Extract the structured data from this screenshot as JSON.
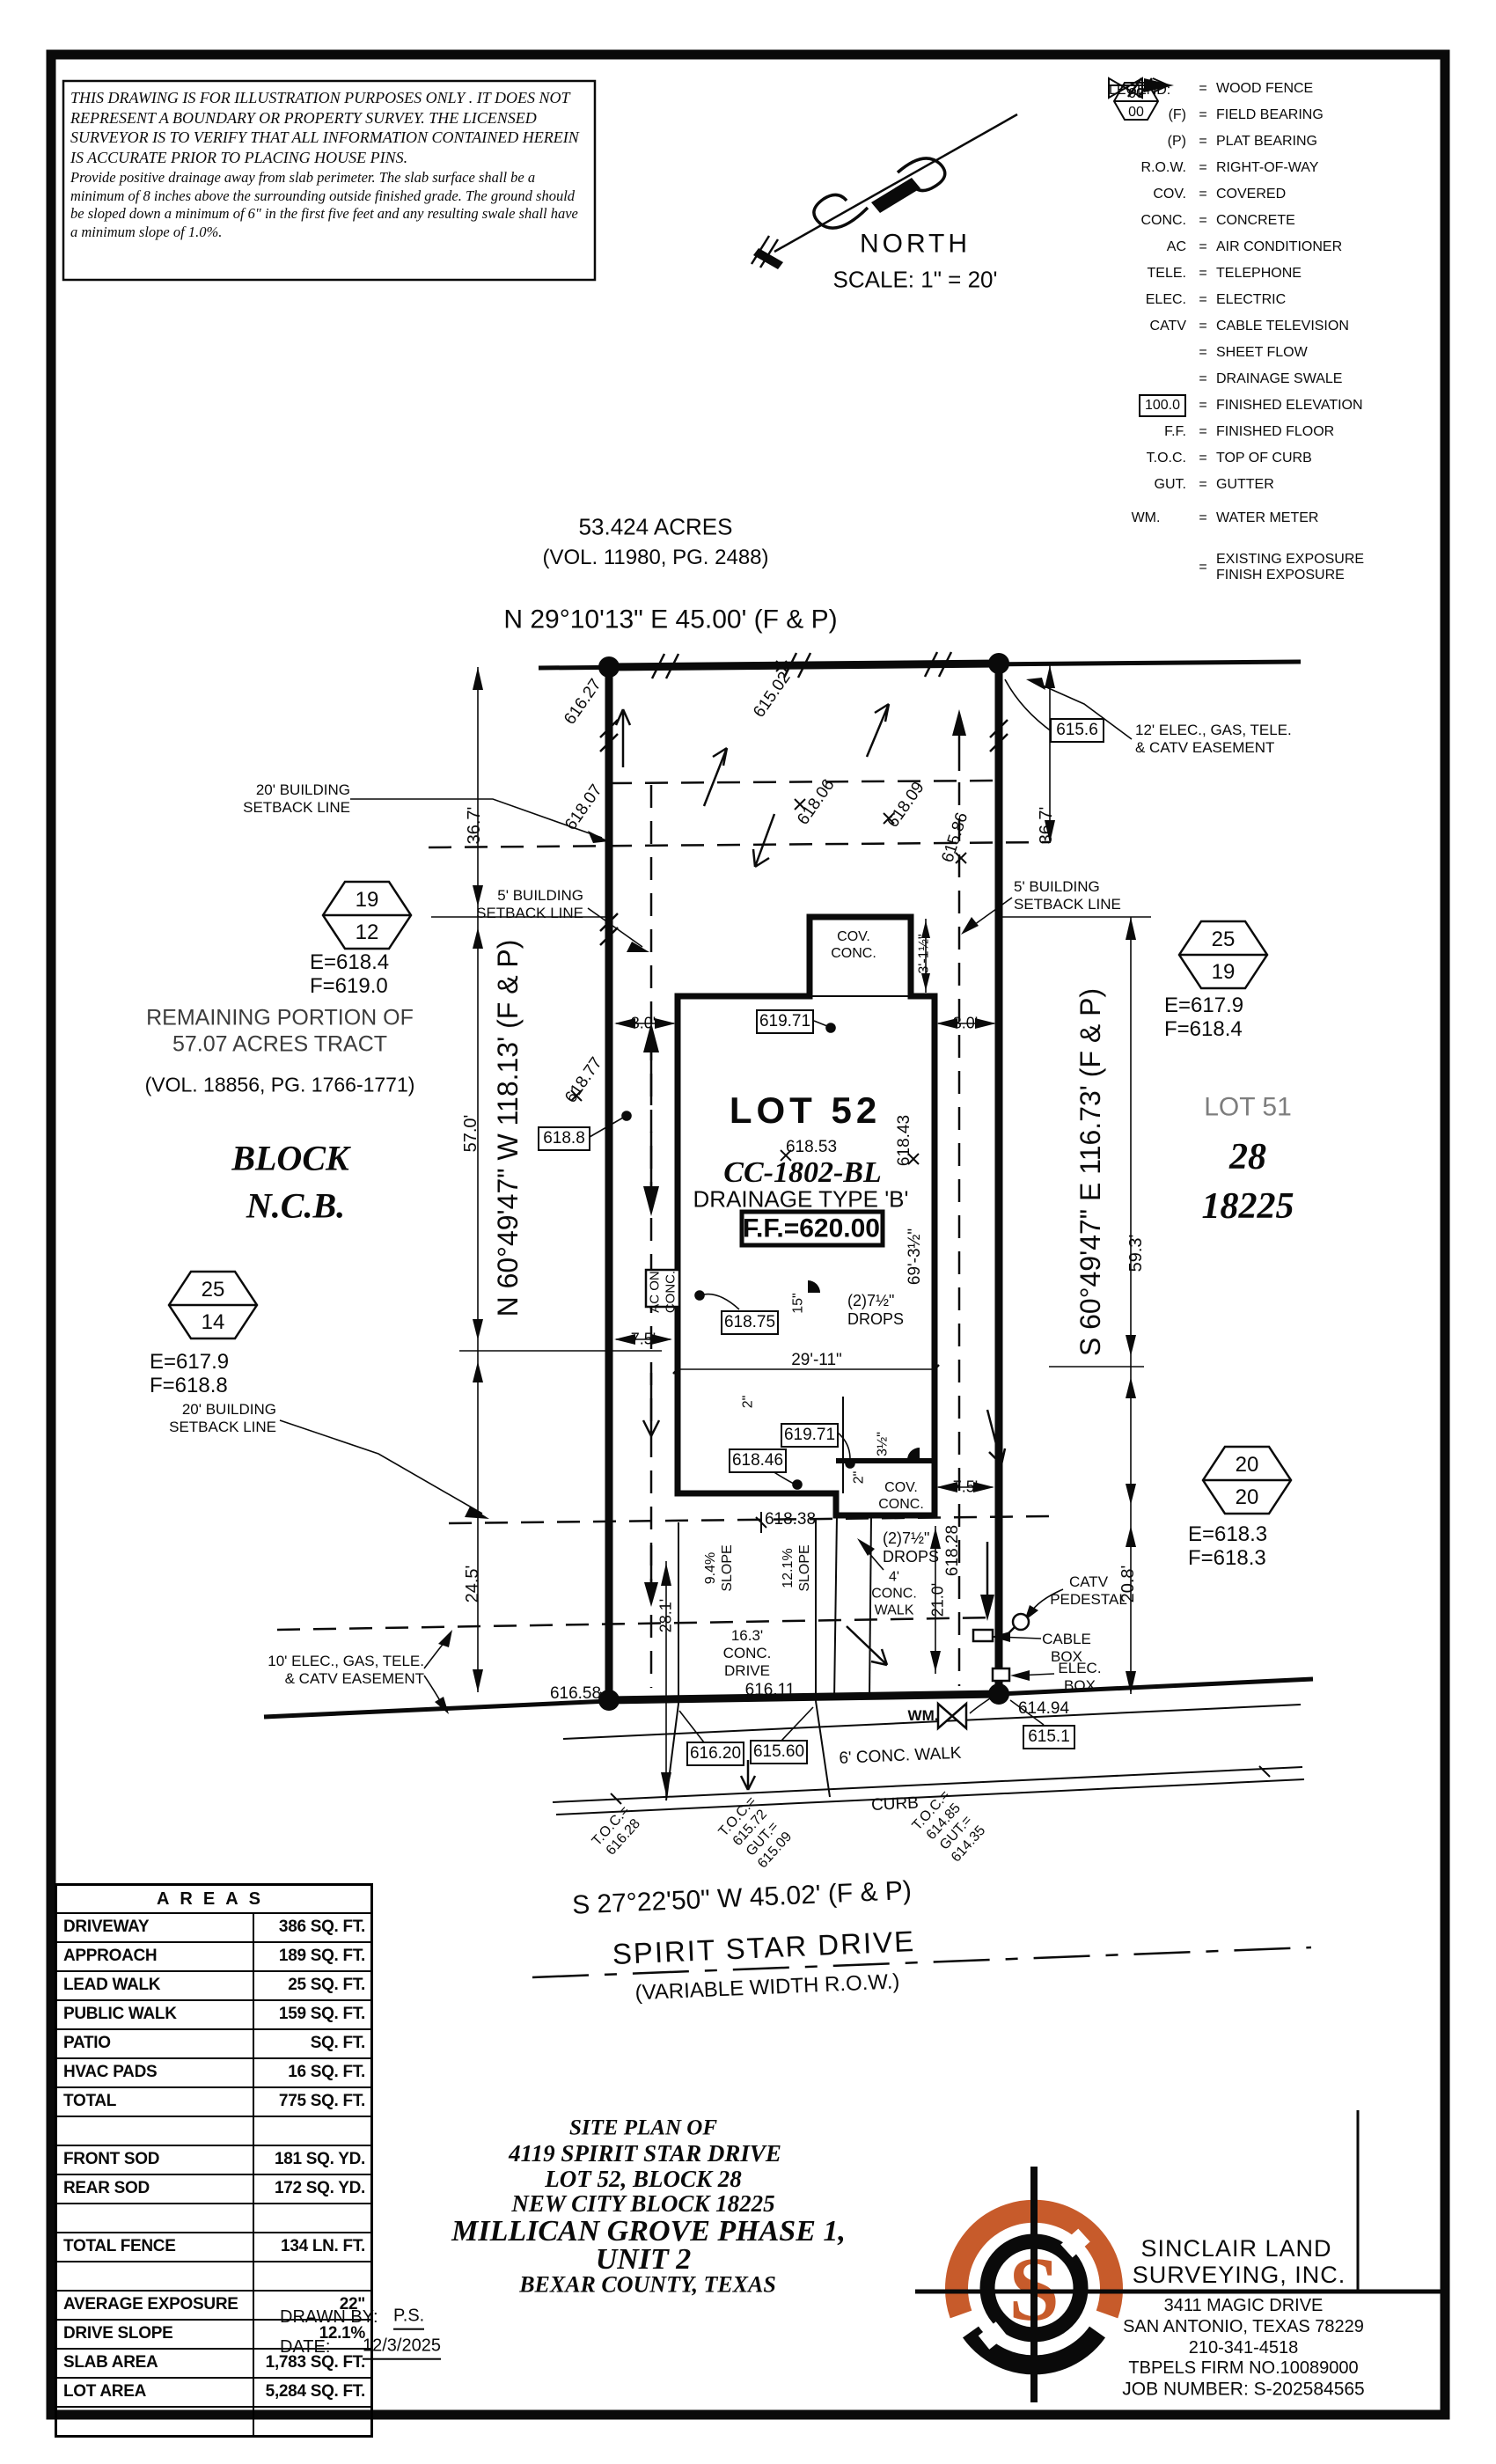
{
  "colors": {
    "accent": "#C75B2B",
    "ink": "#0a0a0a"
  },
  "disclaimer": {
    "caps": "THIS DRAWING IS FOR ILLUSTRATION PURPOSES ONLY . IT DOES NOT REPRESENT A BOUNDARY OR PROPERTY SURVEY. THE LICENSED SURVEYOR IS TO VERIFY THAT ALL INFORMATION CONTAINED HEREIN IS ACCURATE PRIOR TO PLACING HOUSE PINS.",
    "note": "Provide positive drainage away from slab perimeter. The slab surface shall be a minimum of 8 inches above the surrounding outside finished grade. The ground should be sloped down a minimum of 6\" in the first five feet and any resulting swale shall have a minimum slope of 1.0%."
  },
  "north": {
    "label": "NORTH",
    "scale": "SCALE: 1\" = 20'"
  },
  "legend": {
    "title": "LEGEND:",
    "eq": "=",
    "items": [
      {
        "sym": "",
        "def": "WOOD FENCE"
      },
      {
        "sym": "(F)",
        "def": "FIELD BEARING"
      },
      {
        "sym": "(P)",
        "def": "PLAT BEARING"
      },
      {
        "sym": "R.O.W.",
        "def": "RIGHT-OF-WAY"
      },
      {
        "sym": "COV.",
        "def": "COVERED"
      },
      {
        "sym": "CONC.",
        "def": "CONCRETE"
      },
      {
        "sym": "AC",
        "def": "AIR CONDITIONER"
      },
      {
        "sym": "TELE.",
        "def": "TELEPHONE"
      },
      {
        "sym": "ELEC.",
        "def": "ELECTRIC"
      },
      {
        "sym": "CATV",
        "def": "CABLE TELEVISION"
      },
      {
        "sym": "",
        "def": "SHEET FLOW"
      },
      {
        "sym": "",
        "def": "DRAINAGE SWALE"
      },
      {
        "sym": "100.0",
        "def": "FINISHED ELEVATION"
      },
      {
        "sym": "F.F.",
        "def": "FINISHED FLOOR"
      },
      {
        "sym": "T.O.C.",
        "def": "TOP OF CURB"
      },
      {
        "sym": "GUT.",
        "def": "GUTTER"
      },
      {
        "sym": "WM.",
        "def": "WATER METER"
      },
      {
        "sym_top": "00",
        "sym_bottom": "00",
        "def": "EXISTING EXPOSURE",
        "def2": "FINISH EXPOSURE"
      }
    ]
  },
  "plan": {
    "top": {
      "acres": "53.424 ACRES",
      "vol": "(VOL. 11980, PG. 2488)",
      "bearing": "N 29°10'13\" E 45.00' (F & P)"
    },
    "sides": {
      "bearing_left": "N 60°49'47\" W 118.13' (F & P)",
      "bearing_right": "S 60°49'47\" E 116.73' (F & P)",
      "bearing_bottom": "S 27°22'50\" W 45.02' (F & P)",
      "remaining": "REMAINING PORTION OF\n57.07 ACRES TRACT",
      "remaining_vol": "(VOL. 18856, PG. 1766-1771)",
      "block": "BLOCK",
      "ncb": "N.C.B.",
      "lot51": "LOT 51",
      "block28": "28",
      "ncb18225": "18225"
    },
    "labels": {
      "setback20": "20' BUILDING\nSETBACK LINE",
      "setback5": "5' BUILDING\nSETBACK LINE",
      "easement12": "12' ELEC., GAS, TELE.\n& CATV EASEMENT",
      "easement10": "10' ELEC., GAS, TELE.\n& CATV EASEMENT",
      "catv": "CATV\nPEDESTAL",
      "cable": "CABLE\nBOX",
      "elec": "ELEC.\nBOX"
    },
    "dims": {
      "d36_7": "36.7'",
      "d57_0": "57.0'",
      "d24_5": "24.5'",
      "d59_3": "59.3'",
      "d20_8": "20.8'",
      "d28_1": "28.1'",
      "d21_0": "21.0'",
      "d8_0": "8.0'",
      "d7_5": "7.5'",
      "d29_11": "29'-11\"",
      "d69_3h": "69'-3½\"",
      "d3_1h": "3'-1½\"",
      "d3h": "3½\"",
      "d15": "15\"",
      "d2": "2\""
    },
    "spots": {
      "s616_27": "616.27",
      "s615_02": "615.02",
      "s618_07": "618.07",
      "s618_06": "618.06",
      "s618_09": "618.09",
      "s615_86": "615.86",
      "s618_77": "618.77",
      "s618_53": "618.53",
      "s618_43": "618.43",
      "s618_38": "618.38",
      "s618_28": "618.28",
      "s616_58": "616.58",
      "s616_11": "616.11",
      "s614_94": "614.94"
    },
    "fe": {
      "v615_6": "615.6",
      "v619_71": "619.71",
      "v618_75": "618.75",
      "v618_46": "618.46",
      "v618_8": "618.8",
      "v616_20": "616.20",
      "v615_60": "615.60",
      "v615_1": "615.1"
    },
    "house": {
      "lot52": "LOT 52",
      "cc": "CC-1802-BL",
      "drainage": "DRAINAGE TYPE 'B'",
      "ff": "F.F.=620.00",
      "cov": "COV.\nCONC.",
      "drops": "(2)7½\"\nDROPS",
      "ac": "AC ON\nCONC.",
      "slope1": "9.4%\nSLOPE",
      "slope2": "12.1%\nSLOPE",
      "walk4": "4'\nCONC.\nWALK",
      "drive16": "16.3'\nCONC.\nDRIVE",
      "wm": "WM.",
      "walk6": "6' CONC. WALK",
      "curb": "CURB"
    },
    "toc": {
      "t1": "T.O.C.=\n616.28",
      "t2": "T.O.C.=\n615.72\nGUT.=\n615.09",
      "t3": "T.O.C.=\n614.85\nGUT.=\n614.35"
    },
    "street": {
      "name": "SPIRIT STAR DRIVE",
      "row": "(VARIABLE WIDTH R.O.W.)"
    }
  },
  "hexagons": {
    "nw": {
      "top": "19",
      "bottom": "12",
      "e": "E=618.4",
      "f": "F=619.0"
    },
    "w": {
      "top": "25",
      "bottom": "14",
      "e": "E=617.9",
      "f": "F=618.8"
    },
    "ne": {
      "top": "25",
      "bottom": "19",
      "e": "E=617.9",
      "f": "F=618.4"
    },
    "se": {
      "top": "20",
      "bottom": "20",
      "e": "E=618.3",
      "f": "F=618.3"
    }
  },
  "areas": {
    "title": "AREAS",
    "rows": [
      {
        "label": "DRIVEWAY",
        "value": "386 SQ. FT."
      },
      {
        "label": "APPROACH",
        "value": "189 SQ. FT."
      },
      {
        "label": "LEAD WALK",
        "value": "25 SQ. FT."
      },
      {
        "label": "PUBLIC WALK",
        "value": "159 SQ. FT."
      },
      {
        "label": "PATIO",
        "value": "SQ. FT."
      },
      {
        "label": "HVAC PADS",
        "value": "16 SQ. FT."
      },
      {
        "label": "TOTAL",
        "value": "775 SQ. FT."
      },
      {
        "label": "",
        "value": ""
      },
      {
        "label": "FRONT SOD",
        "value": "181 SQ. YD."
      },
      {
        "label": "REAR SOD",
        "value": "172 SQ. YD."
      },
      {
        "label": "",
        "value": ""
      },
      {
        "label": "TOTAL FENCE",
        "value": "134 LN. FT."
      },
      {
        "label": "",
        "value": ""
      },
      {
        "label": "AVERAGE EXPOSURE",
        "value": "22\""
      },
      {
        "label": "DRIVE SLOPE",
        "value": "12.1%"
      },
      {
        "label": "SLAB AREA",
        "value": "1,783 SQ. FT."
      },
      {
        "label": "LOT AREA",
        "value": "5,284 SQ. FT."
      },
      {
        "label": "",
        "value": ""
      }
    ]
  },
  "titleblock": {
    "t1": "SITE PLAN OF",
    "t2": "4119 SPIRIT STAR DRIVE",
    "t3": "LOT 52, BLOCK 28",
    "t4": "NEW CITY BLOCK 18225",
    "t5": "MILLICAN GROVE PHASE 1,",
    "t6": "UNIT 2",
    "t7": "BEXAR COUNTY, TEXAS",
    "drawn_label": "DRAWN BY:",
    "drawn_value": "P.S.",
    "date_label": "DATE:",
    "date_value": "12/3/2025"
  },
  "firm": {
    "logo_letter": "S",
    "name1": "SINCLAIR LAND",
    "name2": "SURVEYING, INC.",
    "addr1": "3411 MAGIC DRIVE",
    "addr2": "SAN ANTONIO, TEXAS 78229",
    "phone": "210-341-4518",
    "tbpels": "TBPELS FIRM NO.10089000",
    "job": "JOB NUMBER: S-202584565"
  }
}
